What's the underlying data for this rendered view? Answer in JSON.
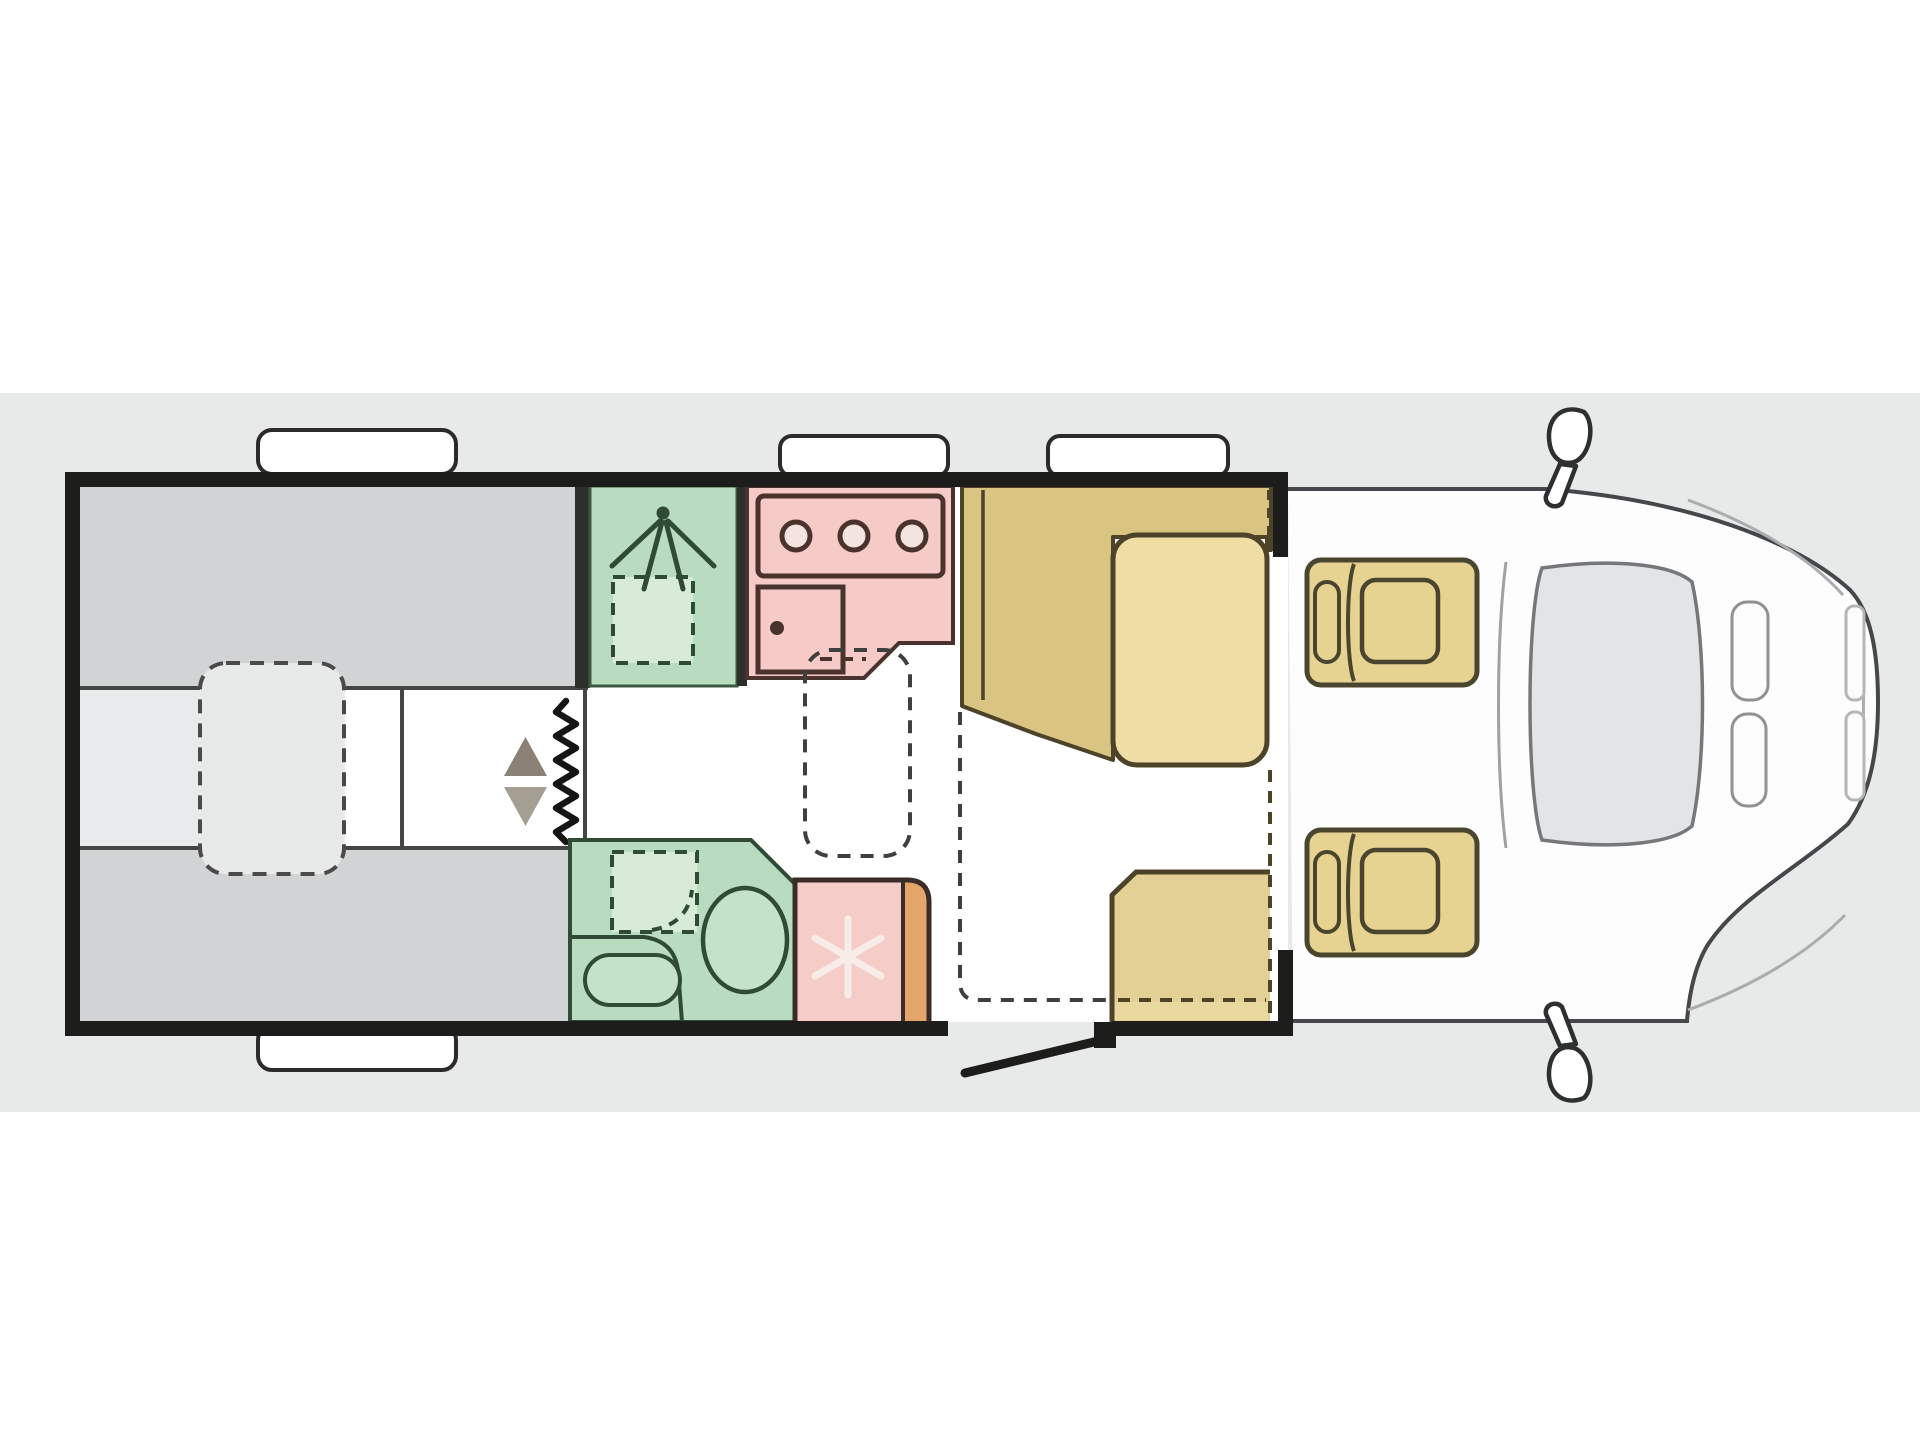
{
  "image": {
    "kind": "motorhome-floorplan-top-view",
    "orientation": "cab-on-right",
    "background_color": "#ffffff",
    "band_color": "#e8e9e9"
  },
  "palette": {
    "wall_black": "#1d1d1b",
    "bed_gray": "#d2d3d4",
    "corridor_gray": "#e9eaeb",
    "room_green": "#b9dcc1",
    "tray_green_light": "#d8ebd8",
    "green_outline": "#2f4a35",
    "kitchen_pink": "#f6cac6",
    "kitchen_outline": "#4a332d",
    "fridge_pink": "#f6ccc8",
    "fridge_orange": "#e3a56a",
    "bench_tan": "#d9c482",
    "cushion_tan": "#eedea6",
    "seat_tan": "#e2d095",
    "cab_seat_tan": "#e6d291",
    "tan_outline": "#4c4329",
    "arrow_up_color": "#8b8174",
    "arrow_down_color": "#a49f92",
    "cab_line_gray": "#45474a",
    "windshield_gray": "#e2e4e6",
    "snowflake_white": "#f8ece9"
  },
  "regions": [
    {
      "name": "rear-twin-bed-top",
      "fill": "bed_gray"
    },
    {
      "name": "rear-twin-bed-bottom",
      "fill": "bed_gray"
    },
    {
      "name": "rear-corridor-step",
      "fill": "corridor_gray"
    },
    {
      "name": "removable-table-dashed",
      "style": "dashed-outline"
    },
    {
      "name": "shower-room",
      "fill": "room_green",
      "icons": [
        "shower-head-icon",
        "shower-tray-dashed"
      ]
    },
    {
      "name": "kitchen",
      "fill": "kitchen_pink",
      "icons": [
        "hob-3-burners",
        "sink-with-faucet"
      ]
    },
    {
      "name": "bathroom",
      "fill": "room_green",
      "icons": [
        "shower-tray-dashed",
        "wash-basin",
        "toilet"
      ]
    },
    {
      "name": "fridge",
      "fill": "fridge_pink",
      "icons": [
        "snowflake-icon"
      ]
    },
    {
      "name": "dinette-l-bench",
      "fill": "bench_tan"
    },
    {
      "name": "dinette-seat-cushion",
      "fill": "cushion_tan"
    },
    {
      "name": "front-bench-seat",
      "fill": "seat_tan"
    },
    {
      "name": "driver-swivel-seat",
      "fill": "cab_seat_tan"
    },
    {
      "name": "passenger-swivel-seat",
      "fill": "cab_seat_tan"
    },
    {
      "name": "entry-door",
      "style": "open-door-leaf"
    },
    {
      "name": "concertina-door",
      "style": "zigzag-line"
    },
    {
      "name": "step-arrows",
      "icons": [
        "arrow-up-icon",
        "arrow-down-icon"
      ]
    },
    {
      "name": "roof-vents",
      "count": 4
    },
    {
      "name": "cab-front",
      "icons": [
        "windshield",
        "headlights",
        "side-mirror-top",
        "side-mirror-bottom"
      ]
    }
  ]
}
